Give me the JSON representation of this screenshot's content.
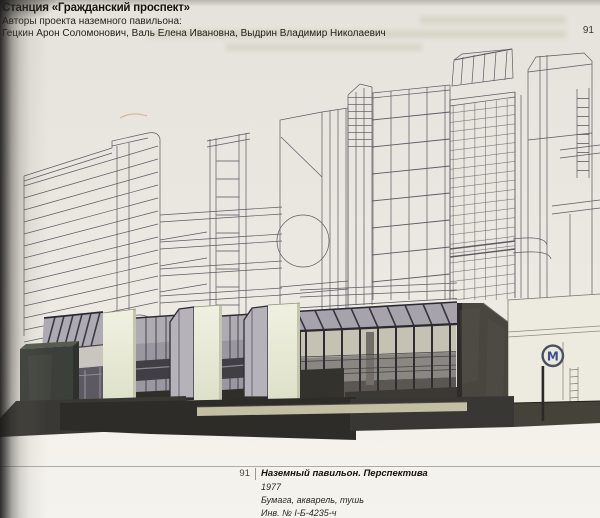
{
  "header": {
    "station_title": "Станция «Гражданский проспект»",
    "authors_label": "Авторы проекта наземного павильона:",
    "authors": "Гецкин Арон Соломонович, Валь Елена Ивановна, Выдрин Владимир Николаевич",
    "page_number": "91"
  },
  "caption": {
    "figure_number": "91",
    "title": "Наземный павильон. Перспектива",
    "year": "1977",
    "medium": "Бумага, акварель, тушь",
    "inventory": "Инв. № I-Б-4235-ч"
  },
  "artwork": {
    "metro_sign_letter": "М",
    "metro_sign_icon": "metro-logo",
    "colors": {
      "paper": "#e9e7df",
      "ink_line": "#5c5b63",
      "pavilion_cream": "#eaecdb",
      "glass_gray": "#938f99",
      "dark_concrete": "#45423c",
      "metro_blue": "#3a4f92",
      "street_dark": "#2e2d2a"
    }
  }
}
